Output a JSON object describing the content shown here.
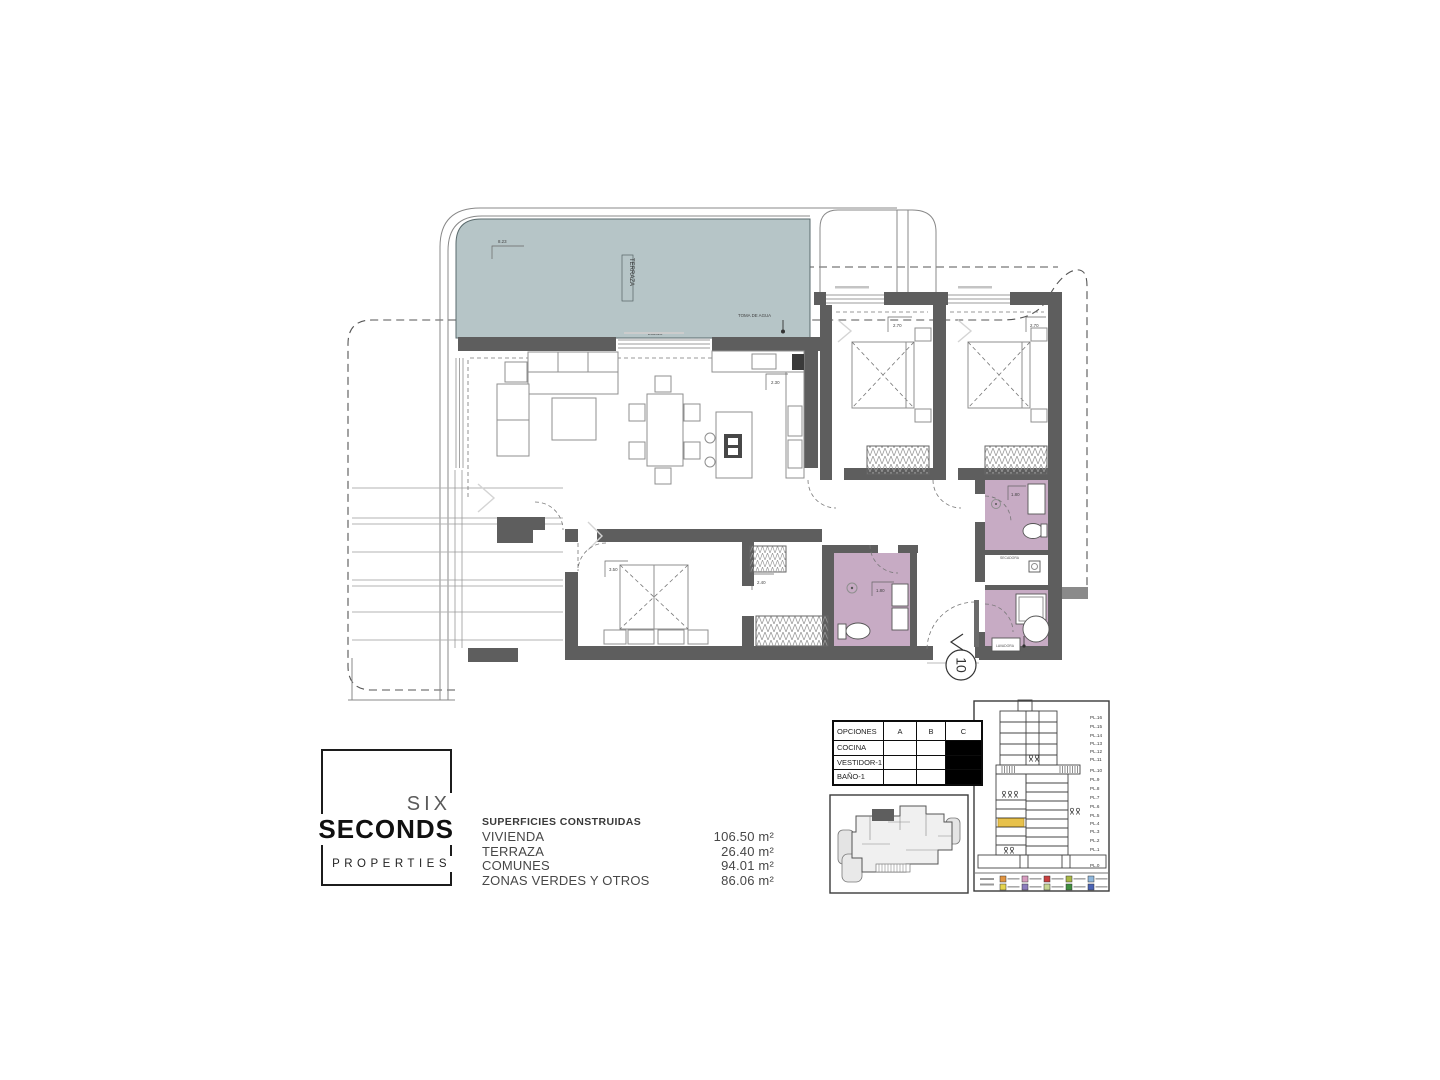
{
  "logo": {
    "line1": "SIX",
    "line2": "SECONDS",
    "line3": "PROPERTIES"
  },
  "superficies": {
    "title": "SUPERFICIES CONSTRUIDAS",
    "rows": [
      {
        "label": "VIVIENDA",
        "value": "106.50 m²"
      },
      {
        "label": "TERRAZA",
        "value": "26.40 m²"
      },
      {
        "label": "COMUNES",
        "value": "94.01 m²"
      },
      {
        "label": "ZONAS VERDES Y OTROS",
        "value": "86.06 m²"
      }
    ]
  },
  "opciones": {
    "headers": [
      "OPCIONES",
      "A",
      "B",
      "C"
    ],
    "rows": [
      {
        "label": "COCINA"
      },
      {
        "label": "VESTIDOR-1"
      },
      {
        "label": "BAÑO-1"
      }
    ],
    "selected_column": "C"
  },
  "plan": {
    "terrace_label": "TERRAZA",
    "water_label": "TOMA DE AGUA",
    "unit_number": "10",
    "labels": {
      "secadora": "SECADORA",
      "lavadora": "LAVADORA"
    },
    "dims": {
      "terrace_width": "8.23",
      "terrace_sill": "235x20",
      "kitchen": "2.30",
      "bedroom2": "2.70",
      "bedroom3": "2.70",
      "master": "3.50",
      "hall": "2.40",
      "bath1": "1.80",
      "bath3": "1.80"
    },
    "colors": {
      "terrace": "#b6c5c7",
      "bathroom": "#c7abc4",
      "wall": "#5e5e5e",
      "highlight": "#e7c14b"
    }
  },
  "section": {
    "floors": [
      "PL.16",
      "PL.15",
      "PL.14",
      "PL.13",
      "PL.12",
      "PL.11",
      "PL.10",
      "PL.9",
      "PL.8",
      "PL.7",
      "PL.6",
      "PL.5",
      "PL.4",
      "PL.3",
      "PL.2",
      "PL.1",
      "PL.0"
    ],
    "legend_colors": [
      "#e2943f",
      "#d79bbf",
      "#c94040",
      "#a9b845",
      "#8fb7dc",
      "#e5d44e",
      "#8b7bbd",
      "#c6d693",
      "#3f8f3f",
      "#4a63b4"
    ]
  }
}
